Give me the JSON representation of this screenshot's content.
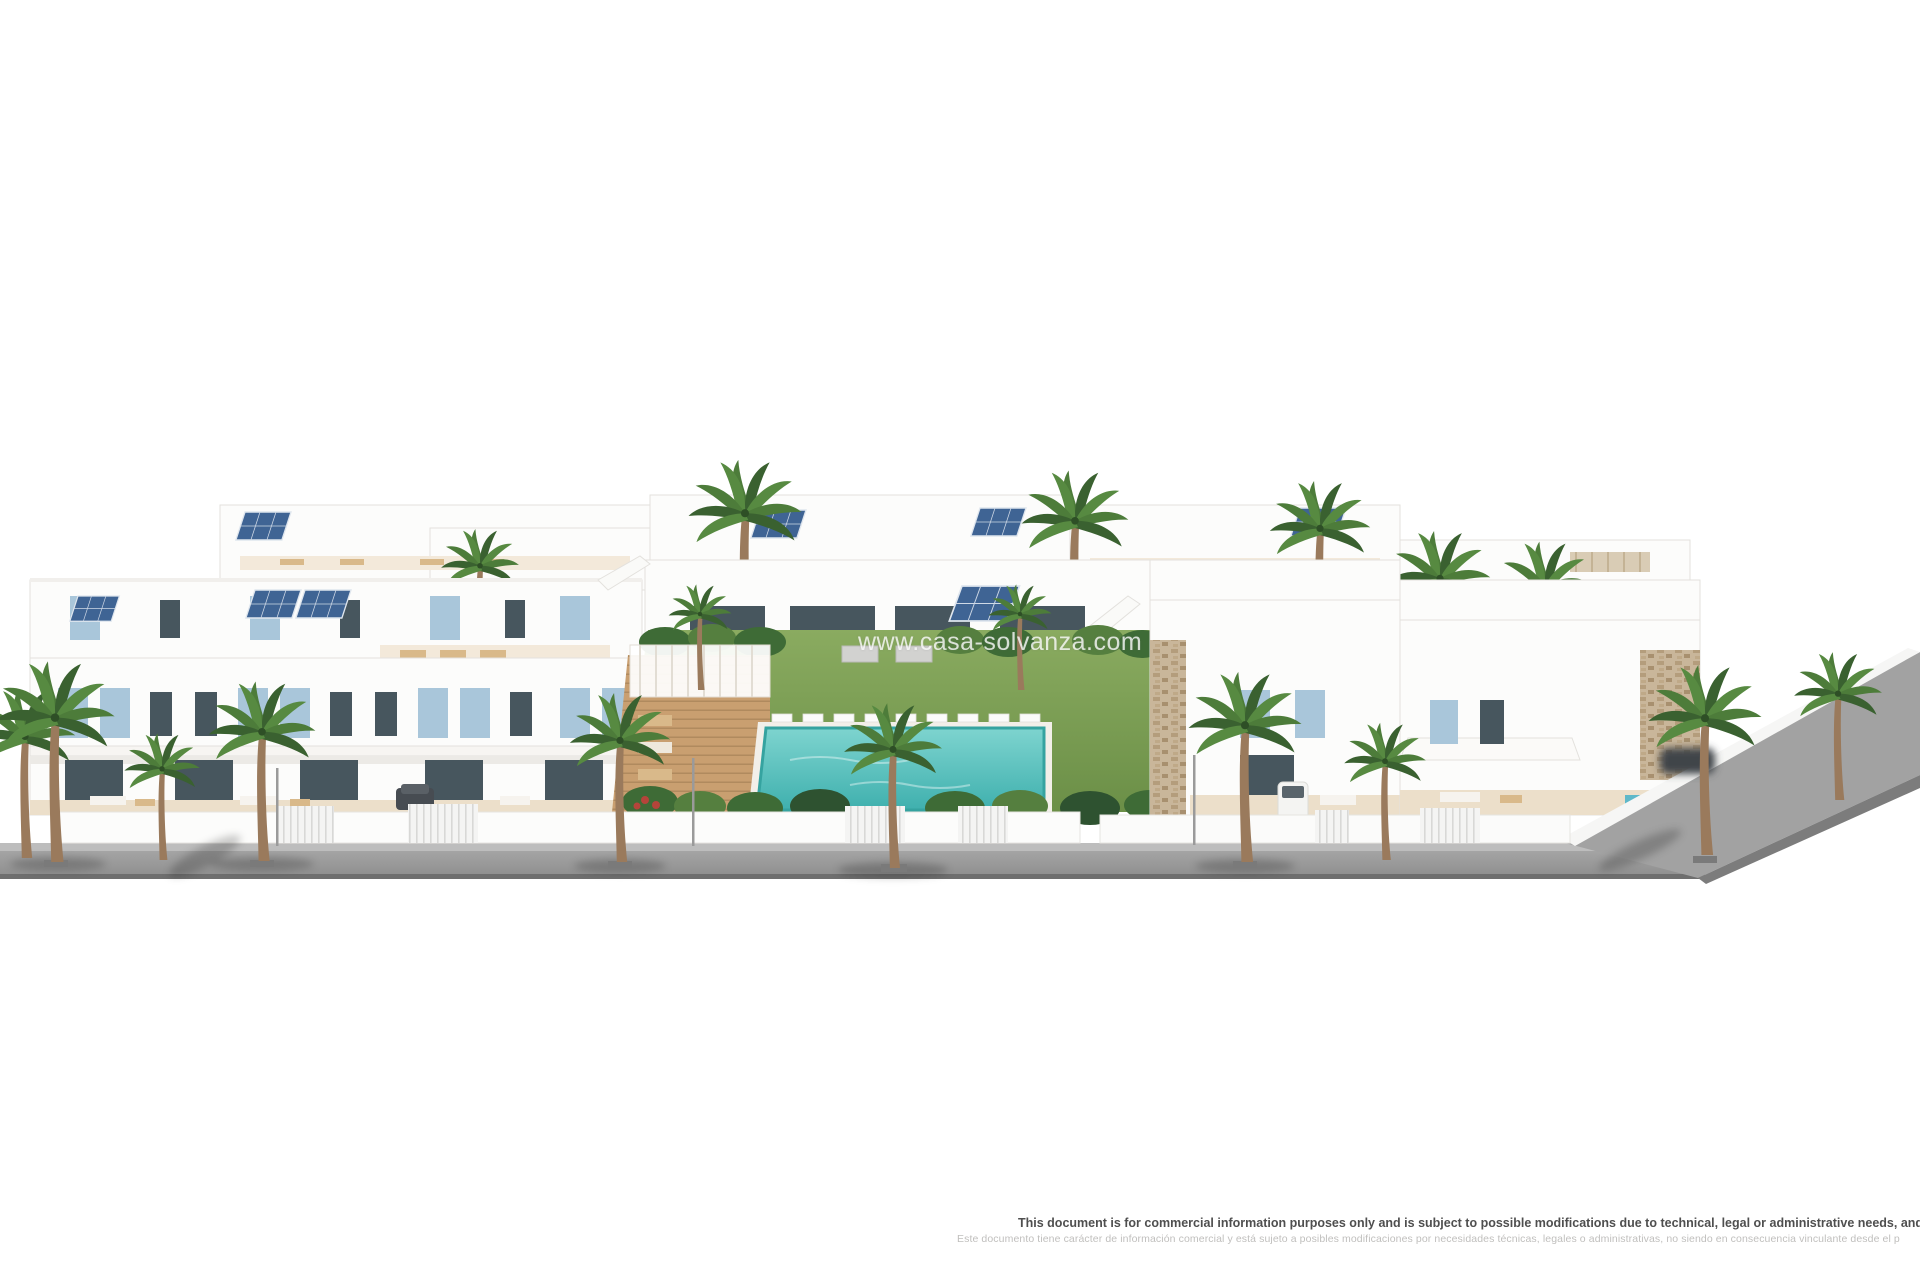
{
  "page": {
    "background": "#ffffff"
  },
  "watermark": {
    "text": "www.casa-solvanza.com"
  },
  "disclaimer": {
    "en": "This document is for commercial information purposes only and is subject to possible modifications due to technical, legal or administrative needs, and is therefore no",
    "es": "Este documento tiene carácter de información comercial y está sujeto a posibles modificaciones por necesidades técnicas, legales o administrativas, no siendo en consecuencia vinculante desde el p"
  },
  "scene": {
    "label": "3D architectural rendering of a white Mediterranean residential complex with palm trees, communal lawn and swimming pool, terraces and front road",
    "palette": {
      "wall_white": "#fcfcfb",
      "wall_shade": "#eceae6",
      "wall_line": "#e3e1dd",
      "shutter_blue": "#a9c6da",
      "solar_blue": "#3f6494",
      "glass_dark": "#47565e",
      "terrace_beige": "#ecdfca",
      "terrace_light": "#f3e9da",
      "furniture_tan": "#d9b98a",
      "stone_beige": "#c9b69a",
      "lawn_green": "#7aa355",
      "bush_green": "#3e6b36",
      "palm_green": "#4d7c3a",
      "palm_green_dark": "#3a6130",
      "palm_green_light": "#578a41",
      "pool_turquoise": "#4fbdbd",
      "pool_rim": "#f2efe9",
      "deck_wood": "#c99f70",
      "road_grey": "#9b9b9b",
      "sidewalk_grey": "#bdbdbd",
      "road_edge": "#6f6f6f",
      "trunk_brown": "#9a7a5c"
    }
  }
}
